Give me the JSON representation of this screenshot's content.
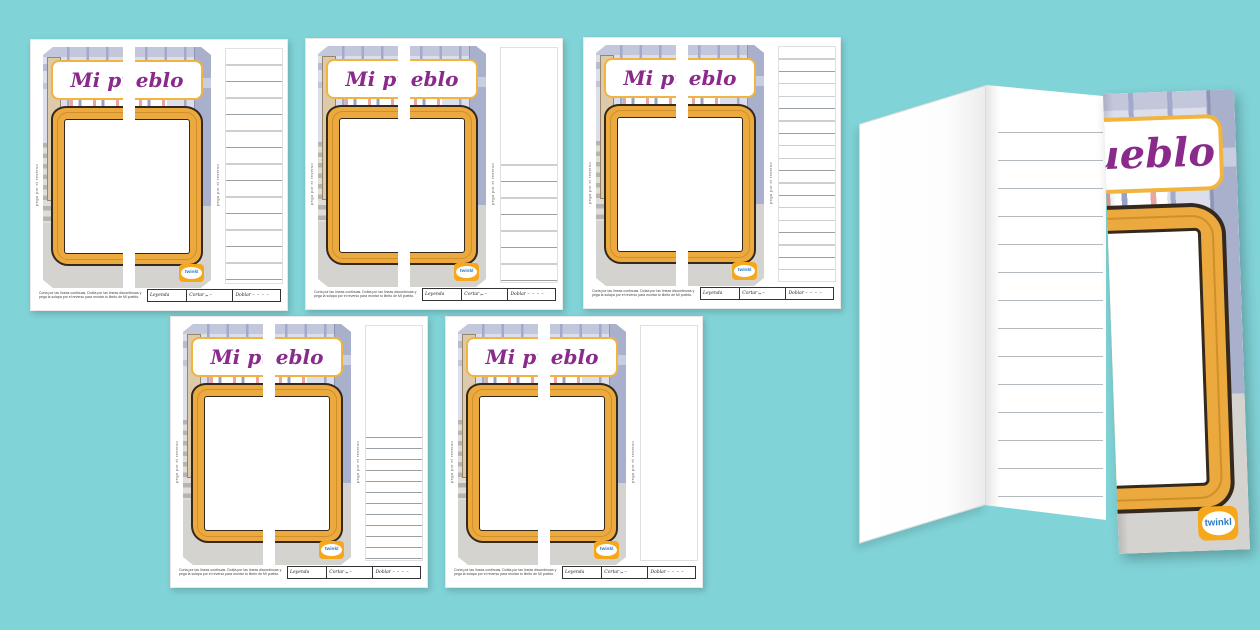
{
  "page": {
    "background_color": "#80d3d7",
    "description_colors": {
      "frame_gold": "#eba93e",
      "title_purple": "#8a2b8c",
      "plate_border_gold": "#f0b43f",
      "logo_orange": "#f6a71b",
      "logo_text_blue": "#2a7ac2",
      "scene_lavender": "#dcdeec",
      "pavement_grey": "#d5d3cf"
    }
  },
  "worksheet": {
    "title": "Mi pueblo",
    "side_text": "pega por el reverso",
    "footer_instructions": "Corta por las líneas continuas. Dobla por las líneas discontinuas y pega la solapa por el reverso para montar tu librito de Mi pueblo.",
    "legend": {
      "title": "Leyenda",
      "cut": "Cortar",
      "cut_symbol": "✂",
      "cut_line": "–",
      "fold": "Doblar",
      "fold_line": "– – – –"
    },
    "logo": "twinkl"
  },
  "thumbnails": [
    {
      "variant": "full-height-lines-wide-spacing",
      "line_style": "full-wide"
    },
    {
      "variant": "half-page-lines-wide-spacing",
      "line_style": "half-wide"
    },
    {
      "variant": "full-height-lines-narrow-spacing",
      "line_style": "full-narrow"
    },
    {
      "variant": "half-page-lines-narrow-spacing",
      "line_style": "half-narrow"
    },
    {
      "variant": "no-lines-blank",
      "line_style": "blank"
    }
  ],
  "mockup": {
    "type": "tri-fold booklet preview",
    "front_title_visible": "ueblo",
    "logo": "twinkl",
    "lined_panel_line_count": 14
  }
}
